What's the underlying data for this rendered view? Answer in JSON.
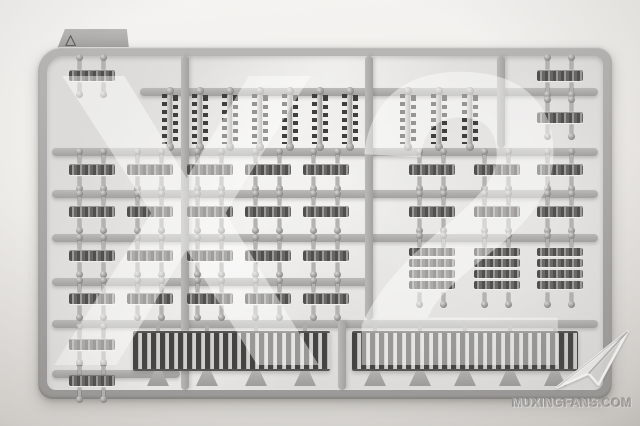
{
  "photo": {
    "watermark_text": "X2",
    "tab_mark": "△",
    "logo_text": "MUXINGFANS.COM"
  },
  "colors": {
    "background_top": "#f5f4f2",
    "background_bottom": "#d9d7d3",
    "sprue_gray": "#a9a8a6",
    "sprue_light": "#bbbab8",
    "panel_gray": "#e1e0de",
    "part_dark": "#4a4947",
    "part_light": "#b4b3b1",
    "watermark_white": "rgba(255,255,255,0.45)",
    "logo_text_gray": "#aeadab"
  },
  "sprue": {
    "frame": {
      "x": 38,
      "y": 47,
      "w": 574,
      "h": 352
    },
    "tab": {
      "x": 57,
      "y": 29,
      "w": 72,
      "h": 20
    },
    "h_bars": [
      {
        "x1": 140,
        "x2": 598,
        "y": 88
      },
      {
        "x1": 52,
        "x2": 598,
        "y": 148
      },
      {
        "x1": 52,
        "x2": 598,
        "y": 190
      },
      {
        "x1": 52,
        "x2": 598,
        "y": 234
      },
      {
        "x1": 52,
        "x2": 372,
        "y": 278
      },
      {
        "x1": 52,
        "x2": 598,
        "y": 320
      },
      {
        "x1": 52,
        "x2": 180,
        "y": 370
      }
    ],
    "v_bars": [
      {
        "x": 181,
        "y1": 56,
        "y2": 390
      },
      {
        "x": 365,
        "y1": 56,
        "y2": 320
      },
      {
        "x": 338,
        "y1": 320,
        "y2": 390
      },
      {
        "x": 497,
        "y1": 56,
        "y2": 148
      }
    ],
    "v_parts": {
      "y": 119,
      "xs": [
        170,
        200,
        230,
        260,
        290,
        320,
        350,
        408,
        439,
        470
      ]
    },
    "h_rows": [
      {
        "y": 76,
        "xs": [
          92,
          560
        ]
      },
      {
        "y": 118,
        "xs": [
          560
        ]
      },
      {
        "y": 170,
        "xs": [
          92,
          150,
          210,
          268,
          326,
          432,
          497,
          560
        ]
      },
      {
        "y": 212,
        "xs": [
          92,
          150,
          210,
          268,
          326,
          432,
          497,
          560
        ]
      },
      {
        "y": 256,
        "xs": [
          92,
          150,
          210,
          268,
          326
        ]
      },
      {
        "y": 299,
        "xs": [
          92,
          150,
          210,
          268,
          326
        ]
      },
      {
        "y": 345,
        "xs": [
          92
        ]
      },
      {
        "y": 381,
        "xs": [
          92
        ]
      }
    ],
    "stacks": {
      "y": 248,
      "xs": [
        432,
        497,
        560
      ]
    },
    "strips": [
      {
        "x": 133,
        "y": 331,
        "w": 197,
        "gates": 4
      },
      {
        "x": 352,
        "y": 331,
        "w": 226,
        "gates": 5
      }
    ]
  }
}
